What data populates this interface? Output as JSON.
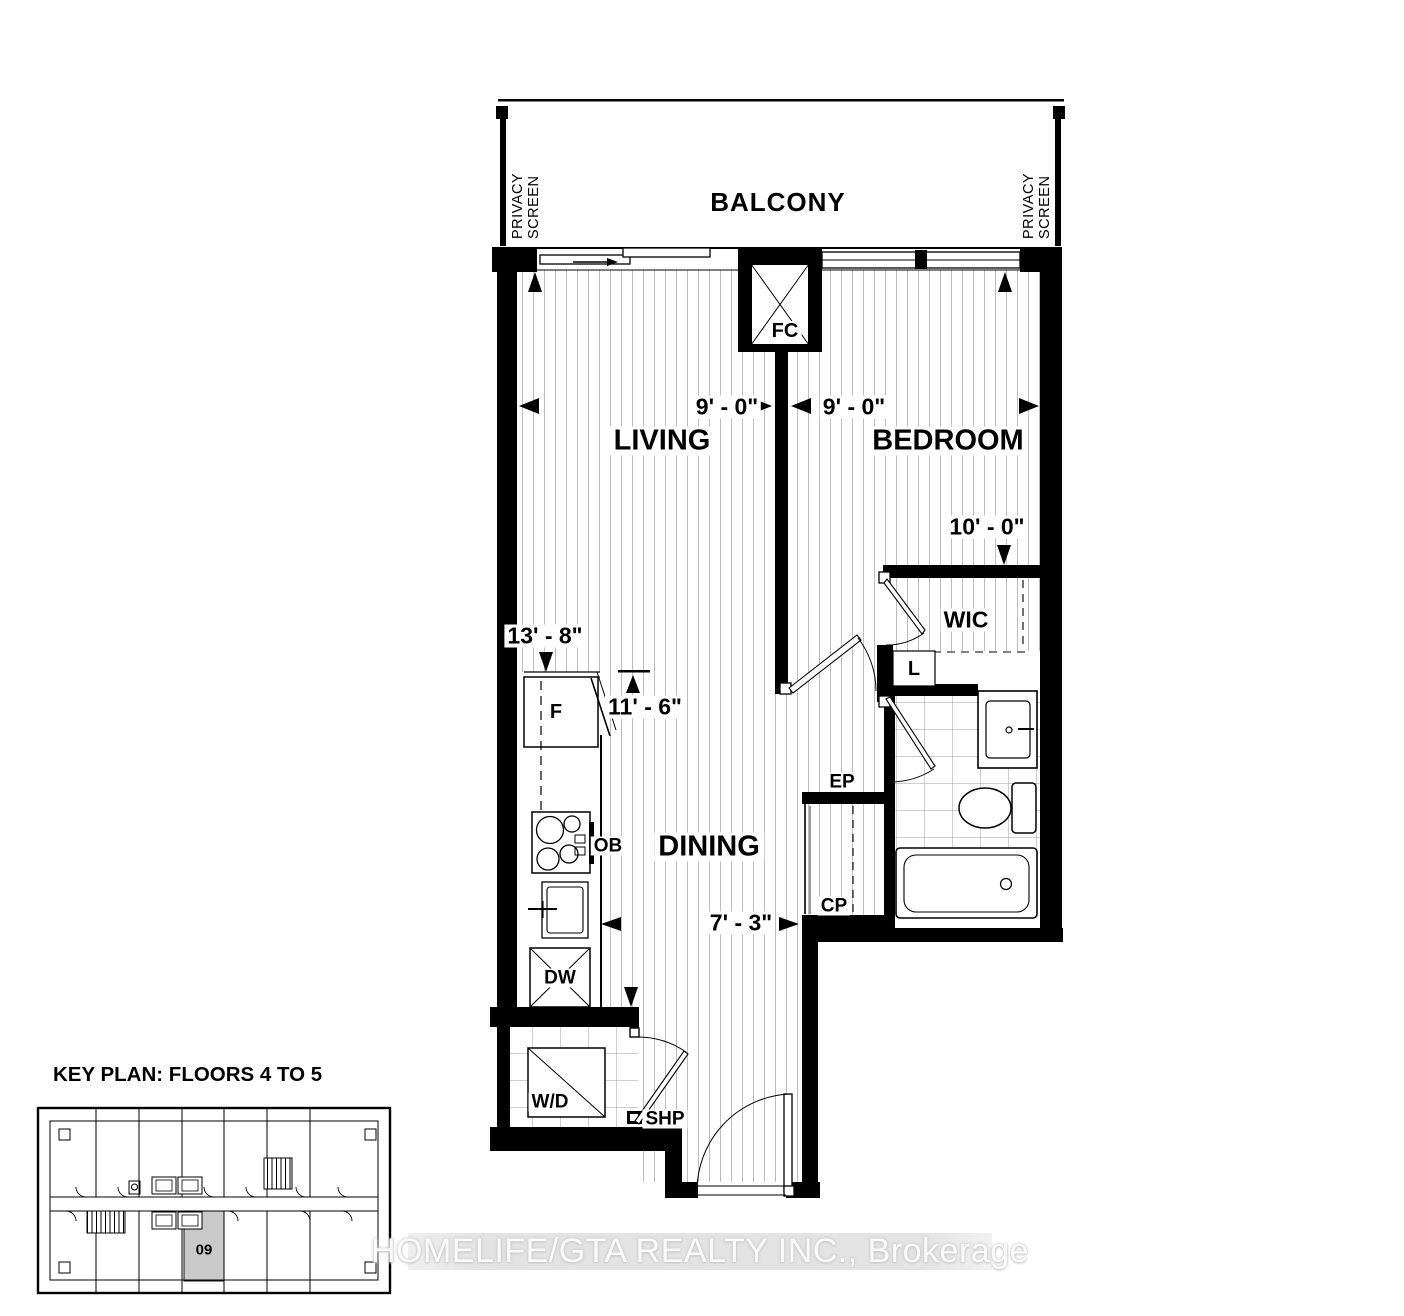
{
  "plan": {
    "balcony": {
      "label": "BALCONY",
      "privacy_screen": "PRIVACY SCREEN"
    },
    "rooms": {
      "living": "LIVING",
      "bedroom": "BEDROOM",
      "dining": "DINING",
      "wic": "WIC",
      "linen": "L"
    },
    "equipment": {
      "fan_coil": "FC",
      "fridge": "F",
      "oven_below": "OB",
      "dishwasher": "DW",
      "washer_dryer": "W/D",
      "shelf": "SHP",
      "electrical_panel": "EP",
      "closet": "CP"
    },
    "dimensions": {
      "living_width": "9' - 0\"",
      "bedroom_width": "9' - 0\"",
      "bedroom_depth": "10' - 0\"",
      "living_depth": "13' - 8\"",
      "dining_length": "11' - 6\"",
      "hall_width": "7' - 3\""
    }
  },
  "key_plan": {
    "title": "KEY PLAN: FLOORS 4 TO 5",
    "highlighted_unit": "09"
  },
  "watermark": "HOMELIFE/GTA REALTY INC., Brokerage",
  "colors": {
    "wall": "#000000",
    "floor_hatch": "#bdbdbd",
    "tile_line": "#9e9e9e",
    "unit_highlight": "#c9c9c9",
    "watermark_band": "#e3e3e3",
    "watermark_text": "#fafafa"
  }
}
